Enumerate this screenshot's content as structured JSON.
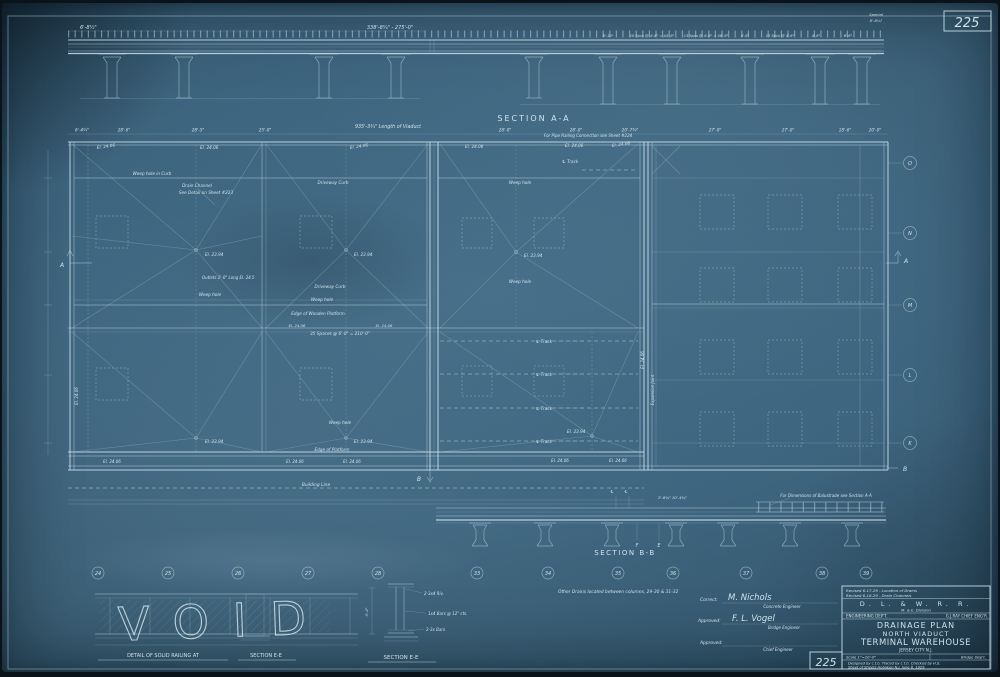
{
  "sheet": {
    "corner_number": "225"
  },
  "top_elevation": {
    "dim_small": "6'-8½\"",
    "dim_main": "338'-8¼\" - 275'-0\"",
    "special_note_1": "Special",
    "special_note_2": "8'-6¼\"",
    "dims_right": [
      "6'-10\"",
      "10 Spcs @ 4'-6\" = 44'-6\"",
      "13 Spcs @ 4'-6\" = 58'-6\"",
      "4'-6\"",
      "13 Spcs @ 4'-6\"",
      "4'-6\"",
      "6'-6\""
    ]
  },
  "section_aa": {
    "label": "SECTION A-A",
    "pipe_railing_note": "For Pipe Railing Connection see Sheet #224"
  },
  "plan": {
    "dim_row": [
      "6'-4¼\"",
      "28'-6\"",
      "28'-5\"",
      "25'-0\"",
      "28'-0\"",
      "28'-0\"",
      "20'-7¾\"",
      "27'-0\"",
      "27'-0\"",
      "18'-6\"",
      "20'-0\""
    ],
    "length_note": "935'-3¾\" Length of Viaduct",
    "labels": {
      "weep_hole_in_curb": "Weep hole in Curb",
      "drain_channel_1": "Drain Channel",
      "drain_channel_2": "See Detail on Sheet #223",
      "driveway_curb": "Driveway Curb",
      "weep_hole": "Weep hole",
      "edge_wooden_platform": "Edge of Wooden Platform",
      "edge_platform": "Edge of Platform",
      "spaces_note": "35 Spaces @ 6'-0\" = 210'-0\"",
      "outlets_note": "Outlets 2'-0\" Long El. 24.5",
      "building_line": "Building Line",
      "track": "℄ Track",
      "expansion_joint": "Expansion Joint",
      "el_2394": "El. 23.94",
      "el_2406": "El. 24.06"
    },
    "row_letters": [
      "O",
      "N",
      "M",
      "L",
      "K"
    ],
    "column_numbers": [
      "24",
      "25",
      "26",
      "27",
      "28",
      "33",
      "34",
      "35",
      "36",
      "37",
      "38",
      "39"
    ]
  },
  "section_bb": {
    "label": "SECTION B-B",
    "dim": "2'-6¾\"  10'-4¾\"",
    "balustrade_note": "For Dimensions of Balustrade see Section A-A",
    "marker_f": "F",
    "marker_e": "E",
    "marker_cl": "℄"
  },
  "markers": {
    "a": "A",
    "b": "B"
  },
  "details": {
    "void_stamp": "VOID",
    "railing_title": "DETAIL OF SOLID RAILING AT",
    "section_ee": "SECTION E-E",
    "ee_label_1": "2-3x4 Riv.",
    "ee_label_2": "1x4 Bars @ 12\" cts.",
    "ee_label_3": "2-3x Bars",
    "ee_dim": "3'-4\""
  },
  "notes": {
    "other_drains": "Other Drains located between columns, 29-30 & 31-32"
  },
  "title_block": {
    "revision_1": "Revised 6-17-29 - Location of Drains",
    "revision_2": "Revised 6-18-29 - Drain Channels",
    "railroad": "D. L. & W. R. R.",
    "division": "M. & E. Division",
    "dept": "ENGINEERING DEP'T.",
    "chief": "G.J.RAY CHIEF ENG'R.",
    "title_1": "DRAINAGE PLAN",
    "title_2": "NORTH VIADUCT",
    "title_3": "TERMINAL WAREHOUSE",
    "title_4": "JERSEY CITY N.J.",
    "scale": "Scale 1\"=10'-0\"",
    "dept_2": "Bridge Dep't.",
    "sheet_no": "225",
    "credits": "Designed by c.t.b.    Traced by c.t.b.    Checked by H.S.",
    "sheet_line": "Sheet    of    Sheets    Hoboken N.J.    June 6, 1929"
  },
  "signatures": {
    "correct_label": "Correct:",
    "correct_sig": "M. Nichols",
    "concrete_engineer": "Concrete Engineer",
    "approved_label": "Approved:",
    "approved_sig": "F. L. Vogel",
    "bridge_engineer": "Bridge Engineer",
    "approved2_label": "Approved:",
    "chief_engineer": "Chief Engineer"
  }
}
